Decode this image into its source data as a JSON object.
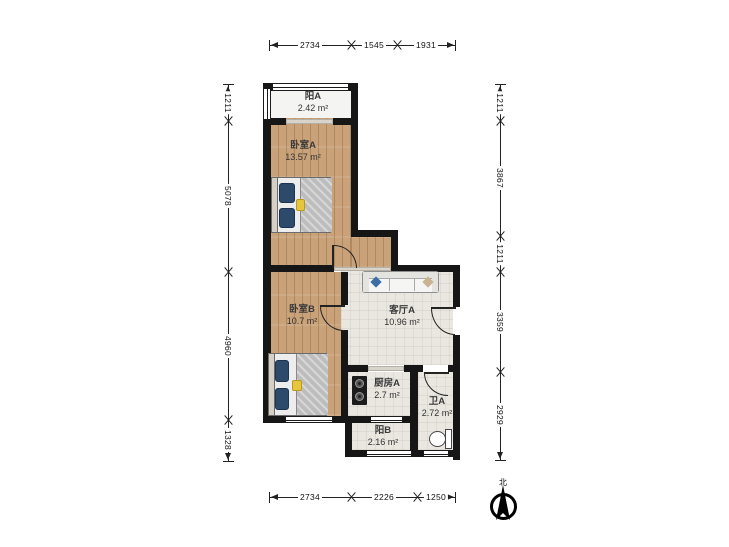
{
  "rooms": {
    "balcony_a": {
      "name": "阳A",
      "area": "2.42 m²"
    },
    "bedroom_a": {
      "name": "卧室A",
      "area": "13.57 m²"
    },
    "bedroom_b": {
      "name": "卧室B",
      "area": "10.7 m²"
    },
    "living": {
      "name": "客厅A",
      "area": "10.96 m²"
    },
    "kitchen": {
      "name": "厨房A",
      "area": "2.7 m²"
    },
    "bath": {
      "name": "卫A",
      "area": "2.72 m²"
    },
    "balcony_b": {
      "name": "阳B",
      "area": "2.16 m²"
    }
  },
  "dims": {
    "top": [
      "2734",
      "1545",
      "1931"
    ],
    "bottom": [
      "2734",
      "2226",
      "1250"
    ],
    "left": [
      "1211",
      "5078",
      "4960",
      "1328"
    ],
    "right": [
      "1211",
      "3867",
      "1211",
      "3359",
      "2929"
    ]
  },
  "compass": {
    "north_label": "北"
  },
  "colors": {
    "wall": "#161616",
    "wood_floor": "#c9a279",
    "tile_floor": "#eae7e0",
    "balcony_floor": "#f4f4f2",
    "pillow_navy": "#2e4a6b",
    "cushion_yellow": "#e7c53d"
  },
  "furniture": {
    "bed_a": "double-bed",
    "bed_b": "double-bed",
    "sofa": "sofa",
    "stove": "gas-stove",
    "toilet": "toilet"
  }
}
